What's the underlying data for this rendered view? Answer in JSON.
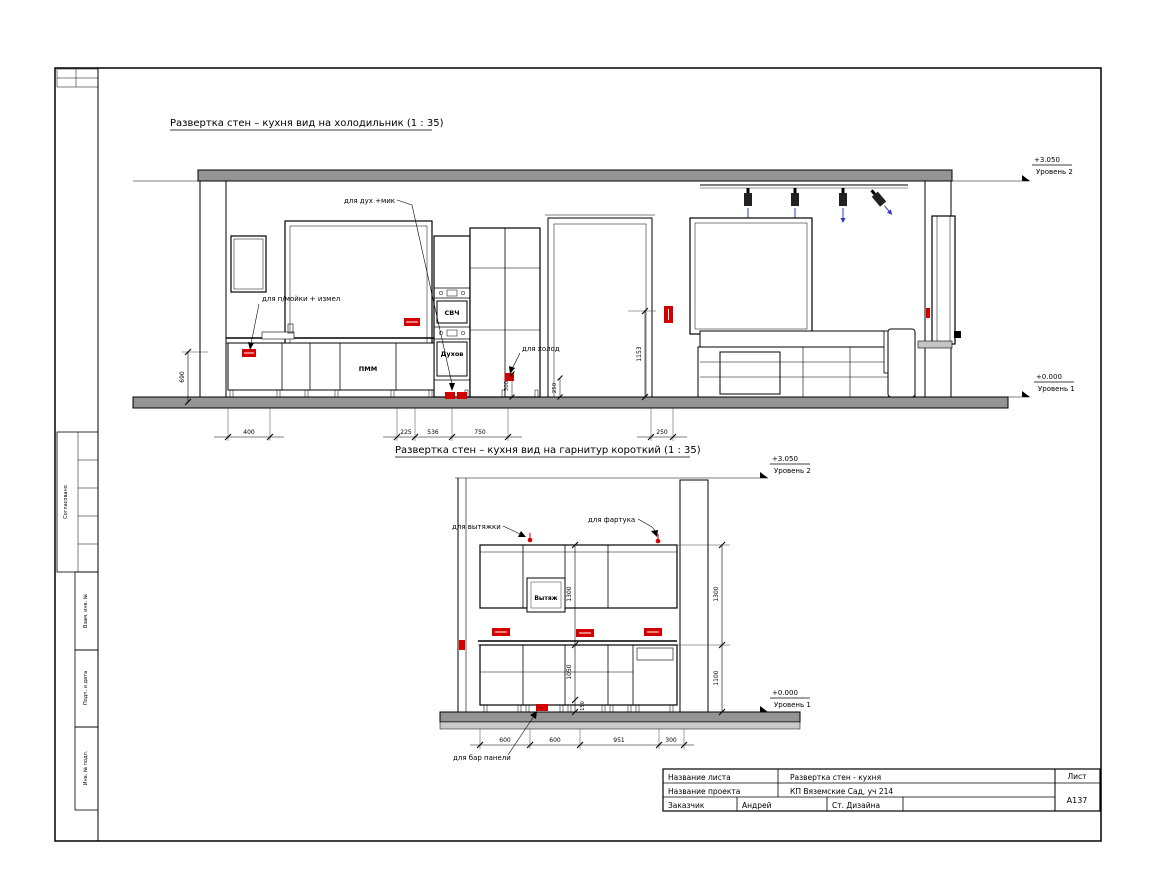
{
  "stamp": {
    "approved": "Согласовано",
    "vzam": "Взам. инв. №",
    "podp": "Подп. и дата",
    "inv": "Инв. № подл."
  },
  "levels": {
    "l2_value": "+3.050",
    "l2_name": "Уровень 2",
    "l1_value": "+0.000",
    "l1_name": "Уровень 1"
  },
  "view1": {
    "title": "Развертка стен – кухня вид на холодильник (1 : 35)",
    "ann_oven": "для дух +мик",
    "ann_sink": "для п/мойки + измел",
    "ann_fridge": "для холод",
    "lbl_microwave": "СВЧ",
    "lbl_oven": "Духов",
    "lbl_dishwasher": "ПММ",
    "dim_w1": "400",
    "dim_w2": "225",
    "dim_w3": "536",
    "dim_w4": "750",
    "dim_w5": "250",
    "dim_h_left": "690",
    "dim_h_door": "1153",
    "dim_h_a": "300",
    "dim_h_b": "250"
  },
  "view2": {
    "title": "Развертка стен – кухня вид на гарнитур короткий (1 : 35)",
    "ann_hood": "для вытяжки",
    "ann_apron": "для фартука",
    "ann_bar": "для бар панели",
    "lbl_hood": "Вытяж",
    "dim_h_upper": "1300",
    "dim_h_upper_r": "1300",
    "dim_h_base": "1050",
    "dim_h_base_r": "1100",
    "dim_h_plinth": "150",
    "dim_w1": "600",
    "dim_w2": "600",
    "dim_w3": "951",
    "dim_w4": "300"
  },
  "titleblock": {
    "row1_label": "Название листа",
    "row1_value": "Развертка стен - кухня",
    "sheet_label": "Лист",
    "row2_label": "Название проекта",
    "row2_value": "КП Вяземские Сад, уч 214",
    "sheet_number": "А137",
    "row3_label": "Заказчик",
    "row3_value1": "Андрей",
    "row3_value2": "Ст. Дизайна"
  }
}
